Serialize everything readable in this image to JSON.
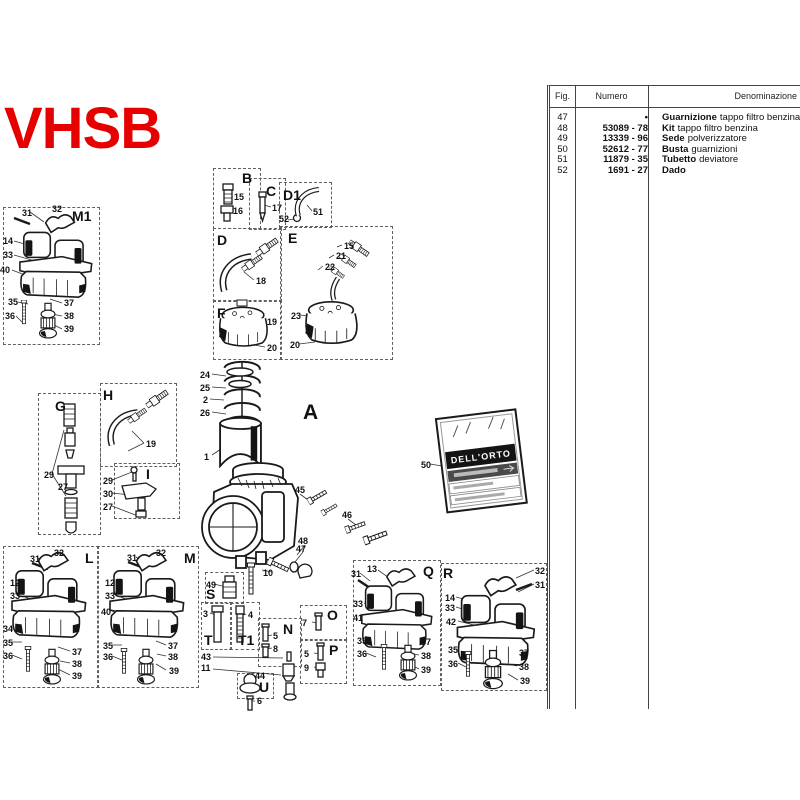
{
  "title": {
    "text": "VHSB",
    "color": "#e60000"
  },
  "main": {
    "area_label": "A"
  },
  "bag": {
    "brand": "DELL'ORTO"
  },
  "table": {
    "headers": {
      "fig": "Fig.",
      "numero": "Numero",
      "denominazione": "Denominazione"
    },
    "rows": [
      {
        "fig": "47",
        "numero": "•",
        "bold": "Guarnizione",
        "rest": "tappo filtro benzina"
      },
      {
        "fig": "48",
        "numero": "53089 - 78",
        "bold": "Kit",
        "rest": "tappo filtro benzina"
      },
      {
        "fig": "49",
        "numero": "13339 - 96",
        "bold": "Sede",
        "rest": "polverizzatore"
      },
      {
        "fig": "50",
        "numero": "52612 - 77",
        "bold": "Busta",
        "rest": "guarnizioni"
      },
      {
        "fig": "51",
        "numero": "11879 - 35",
        "bold": "Tubetto",
        "rest": "deviatore"
      },
      {
        "fig": "52",
        "numero": "1691 - 27",
        "bold": "Dado",
        "rest": ""
      }
    ]
  },
  "sections": [
    {
      "label": "M1",
      "x": 3,
      "y": 207,
      "w": 95,
      "h": 136,
      "lx": 72,
      "ly": 208
    },
    {
      "label": "B",
      "x": 213,
      "y": 168,
      "w": 46,
      "h": 59,
      "lx": 242,
      "ly": 170
    },
    {
      "label": "C",
      "x": 249,
      "y": 178,
      "w": 35,
      "h": 50,
      "lx": 266,
      "ly": 183
    },
    {
      "label": "D1",
      "x": 279,
      "y": 182,
      "w": 51,
      "h": 44,
      "lx": 283,
      "ly": 187
    },
    {
      "label": "D",
      "x": 213,
      "y": 228,
      "w": 67,
      "h": 72,
      "lx": 217,
      "ly": 232
    },
    {
      "label": "E",
      "x": 280,
      "y": 226,
      "w": 111,
      "h": 132,
      "lx": 288,
      "ly": 230
    },
    {
      "label": "F",
      "x": 213,
      "y": 300,
      "w": 67,
      "h": 58,
      "lx": 217,
      "ly": 305
    },
    {
      "label": "G",
      "x": 38,
      "y": 393,
      "w": 61,
      "h": 140,
      "lx": 55,
      "ly": 398
    },
    {
      "label": "H",
      "x": 100,
      "y": 383,
      "w": 75,
      "h": 82,
      "lx": 103,
      "ly": 387
    },
    {
      "label": "I",
      "x": 114,
      "y": 463,
      "w": 64,
      "h": 54,
      "lx": 146,
      "ly": 466
    },
    {
      "label": "L",
      "x": 3,
      "y": 546,
      "w": 94,
      "h": 140,
      "lx": 85,
      "ly": 550
    },
    {
      "label": "M",
      "x": 97,
      "y": 546,
      "w": 100,
      "h": 140,
      "lx": 184,
      "ly": 550
    },
    {
      "label": "S",
      "x": 205,
      "y": 572,
      "w": 37,
      "h": 30,
      "lx": 206,
      "ly": 586
    },
    {
      "label": "T",
      "x": 201,
      "y": 602,
      "w": 29,
      "h": 46,
      "lx": 204,
      "ly": 632
    },
    {
      "label": "T1",
      "x": 230,
      "y": 602,
      "w": 28,
      "h": 46,
      "lx": 238,
      "ly": 632
    },
    {
      "label": "N",
      "x": 258,
      "y": 618,
      "w": 42,
      "h": 47,
      "lx": 283,
      "ly": 621
    },
    {
      "label": "O",
      "x": 300,
      "y": 605,
      "w": 45,
      "h": 33,
      "lx": 327,
      "ly": 607
    },
    {
      "label": "P",
      "x": 300,
      "y": 640,
      "w": 45,
      "h": 42,
      "lx": 329,
      "ly": 642
    },
    {
      "label": "U",
      "x": 237,
      "y": 673,
      "w": 35,
      "h": 24,
      "lx": 259,
      "ly": 679
    },
    {
      "label": "Q",
      "x": 353,
      "y": 560,
      "w": 86,
      "h": 124,
      "lx": 423,
      "ly": 563
    },
    {
      "label": "R",
      "x": 441,
      "y": 563,
      "w": 104,
      "h": 126,
      "lx": 443,
      "ly": 565
    }
  ],
  "callouts": [
    {
      "t": "31",
      "x": 22,
      "y": 209
    },
    {
      "t": "32",
      "x": 52,
      "y": 205
    },
    {
      "t": "14",
      "x": 3,
      "y": 237
    },
    {
      "t": "33",
      "x": 3,
      "y": 251
    },
    {
      "t": "40",
      "x": 0,
      "y": 266
    },
    {
      "t": "35",
      "x": 8,
      "y": 298
    },
    {
      "t": "36",
      "x": 5,
      "y": 312
    },
    {
      "t": "37",
      "x": 64,
      "y": 299
    },
    {
      "t": "38",
      "x": 64,
      "y": 312
    },
    {
      "t": "39",
      "x": 64,
      "y": 325
    },
    {
      "t": "15",
      "x": 234,
      "y": 193
    },
    {
      "t": "16",
      "x": 233,
      "y": 207
    },
    {
      "t": "17",
      "x": 272,
      "y": 204
    },
    {
      "t": "51",
      "x": 313,
      "y": 208
    },
    {
      "t": "52",
      "x": 279,
      "y": 215
    },
    {
      "t": "18",
      "x": 256,
      "y": 277
    },
    {
      "t": "15",
      "x": 344,
      "y": 242
    },
    {
      "t": "21",
      "x": 336,
      "y": 252
    },
    {
      "t": "22",
      "x": 325,
      "y": 263
    },
    {
      "t": "23",
      "x": 291,
      "y": 312
    },
    {
      "t": "20",
      "x": 290,
      "y": 341
    },
    {
      "t": "19",
      "x": 267,
      "y": 318
    },
    {
      "t": "20",
      "x": 267,
      "y": 344
    },
    {
      "t": "24",
      "x": 200,
      "y": 371
    },
    {
      "t": "25",
      "x": 200,
      "y": 384
    },
    {
      "t": "2",
      "x": 203,
      "y": 396
    },
    {
      "t": "26",
      "x": 200,
      "y": 409
    },
    {
      "t": "1",
      "x": 204,
      "y": 453
    },
    {
      "t": "45",
      "x": 295,
      "y": 486
    },
    {
      "t": "46",
      "x": 342,
      "y": 511
    },
    {
      "t": "48",
      "x": 298,
      "y": 537
    },
    {
      "t": "47",
      "x": 296,
      "y": 545
    },
    {
      "t": "10",
      "x": 263,
      "y": 569
    },
    {
      "t": "49",
      "x": 206,
      "y": 581
    },
    {
      "t": "3",
      "x": 203,
      "y": 610
    },
    {
      "t": "4",
      "x": 248,
      "y": 611
    },
    {
      "t": "43",
      "x": 201,
      "y": 653
    },
    {
      "t": "11",
      "x": 201,
      "y": 664
    },
    {
      "t": "5",
      "x": 273,
      "y": 632
    },
    {
      "t": "8",
      "x": 273,
      "y": 645
    },
    {
      "t": "7",
      "x": 302,
      "y": 619
    },
    {
      "t": "5",
      "x": 304,
      "y": 650
    },
    {
      "t": "9",
      "x": 304,
      "y": 664
    },
    {
      "t": "44",
      "x": 255,
      "y": 672
    },
    {
      "t": "6",
      "x": 257,
      "y": 697
    },
    {
      "t": "29",
      "x": 44,
      "y": 471
    },
    {
      "t": "27",
      "x": 58,
      "y": 483
    },
    {
      "t": "19",
      "x": 146,
      "y": 440
    },
    {
      "t": "29",
      "x": 103,
      "y": 477
    },
    {
      "t": "30",
      "x": 103,
      "y": 490
    },
    {
      "t": "27",
      "x": 103,
      "y": 503
    },
    {
      "t": "31",
      "x": 30,
      "y": 555
    },
    {
      "t": "32",
      "x": 54,
      "y": 549
    },
    {
      "t": "12",
      "x": 10,
      "y": 579
    },
    {
      "t": "33",
      "x": 10,
      "y": 592
    },
    {
      "t": "34",
      "x": 3,
      "y": 625
    },
    {
      "t": "35",
      "x": 3,
      "y": 639
    },
    {
      "t": "36",
      "x": 3,
      "y": 652
    },
    {
      "t": "37",
      "x": 72,
      "y": 648
    },
    {
      "t": "38",
      "x": 72,
      "y": 660
    },
    {
      "t": "39",
      "x": 72,
      "y": 672
    },
    {
      "t": "31",
      "x": 127,
      "y": 554
    },
    {
      "t": "32",
      "x": 156,
      "y": 549
    },
    {
      "t": "12",
      "x": 105,
      "y": 579
    },
    {
      "t": "33",
      "x": 105,
      "y": 592
    },
    {
      "t": "40",
      "x": 101,
      "y": 608
    },
    {
      "t": "35",
      "x": 103,
      "y": 642
    },
    {
      "t": "36",
      "x": 103,
      "y": 653
    },
    {
      "t": "37",
      "x": 168,
      "y": 642
    },
    {
      "t": "38",
      "x": 168,
      "y": 653
    },
    {
      "t": "39",
      "x": 169,
      "y": 667
    },
    {
      "t": "31",
      "x": 351,
      "y": 570
    },
    {
      "t": "13",
      "x": 367,
      "y": 565
    },
    {
      "t": "33",
      "x": 353,
      "y": 600
    },
    {
      "t": "41",
      "x": 353,
      "y": 614
    },
    {
      "t": "35",
      "x": 357,
      "y": 637
    },
    {
      "t": "36",
      "x": 357,
      "y": 650
    },
    {
      "t": "37",
      "x": 421,
      "y": 638
    },
    {
      "t": "38",
      "x": 421,
      "y": 652
    },
    {
      "t": "39",
      "x": 421,
      "y": 666
    },
    {
      "t": "32",
      "x": 535,
      "y": 567
    },
    {
      "t": "31",
      "x": 535,
      "y": 581
    },
    {
      "t": "14",
      "x": 445,
      "y": 594
    },
    {
      "t": "33",
      "x": 445,
      "y": 604
    },
    {
      "t": "42",
      "x": 446,
      "y": 618
    },
    {
      "t": "35",
      "x": 448,
      "y": 646
    },
    {
      "t": "36",
      "x": 448,
      "y": 660
    },
    {
      "t": "37",
      "x": 519,
      "y": 649
    },
    {
      "t": "38",
      "x": 519,
      "y": 663
    },
    {
      "t": "39",
      "x": 520,
      "y": 677
    },
    {
      "t": "50",
      "x": 421,
      "y": 461
    }
  ]
}
